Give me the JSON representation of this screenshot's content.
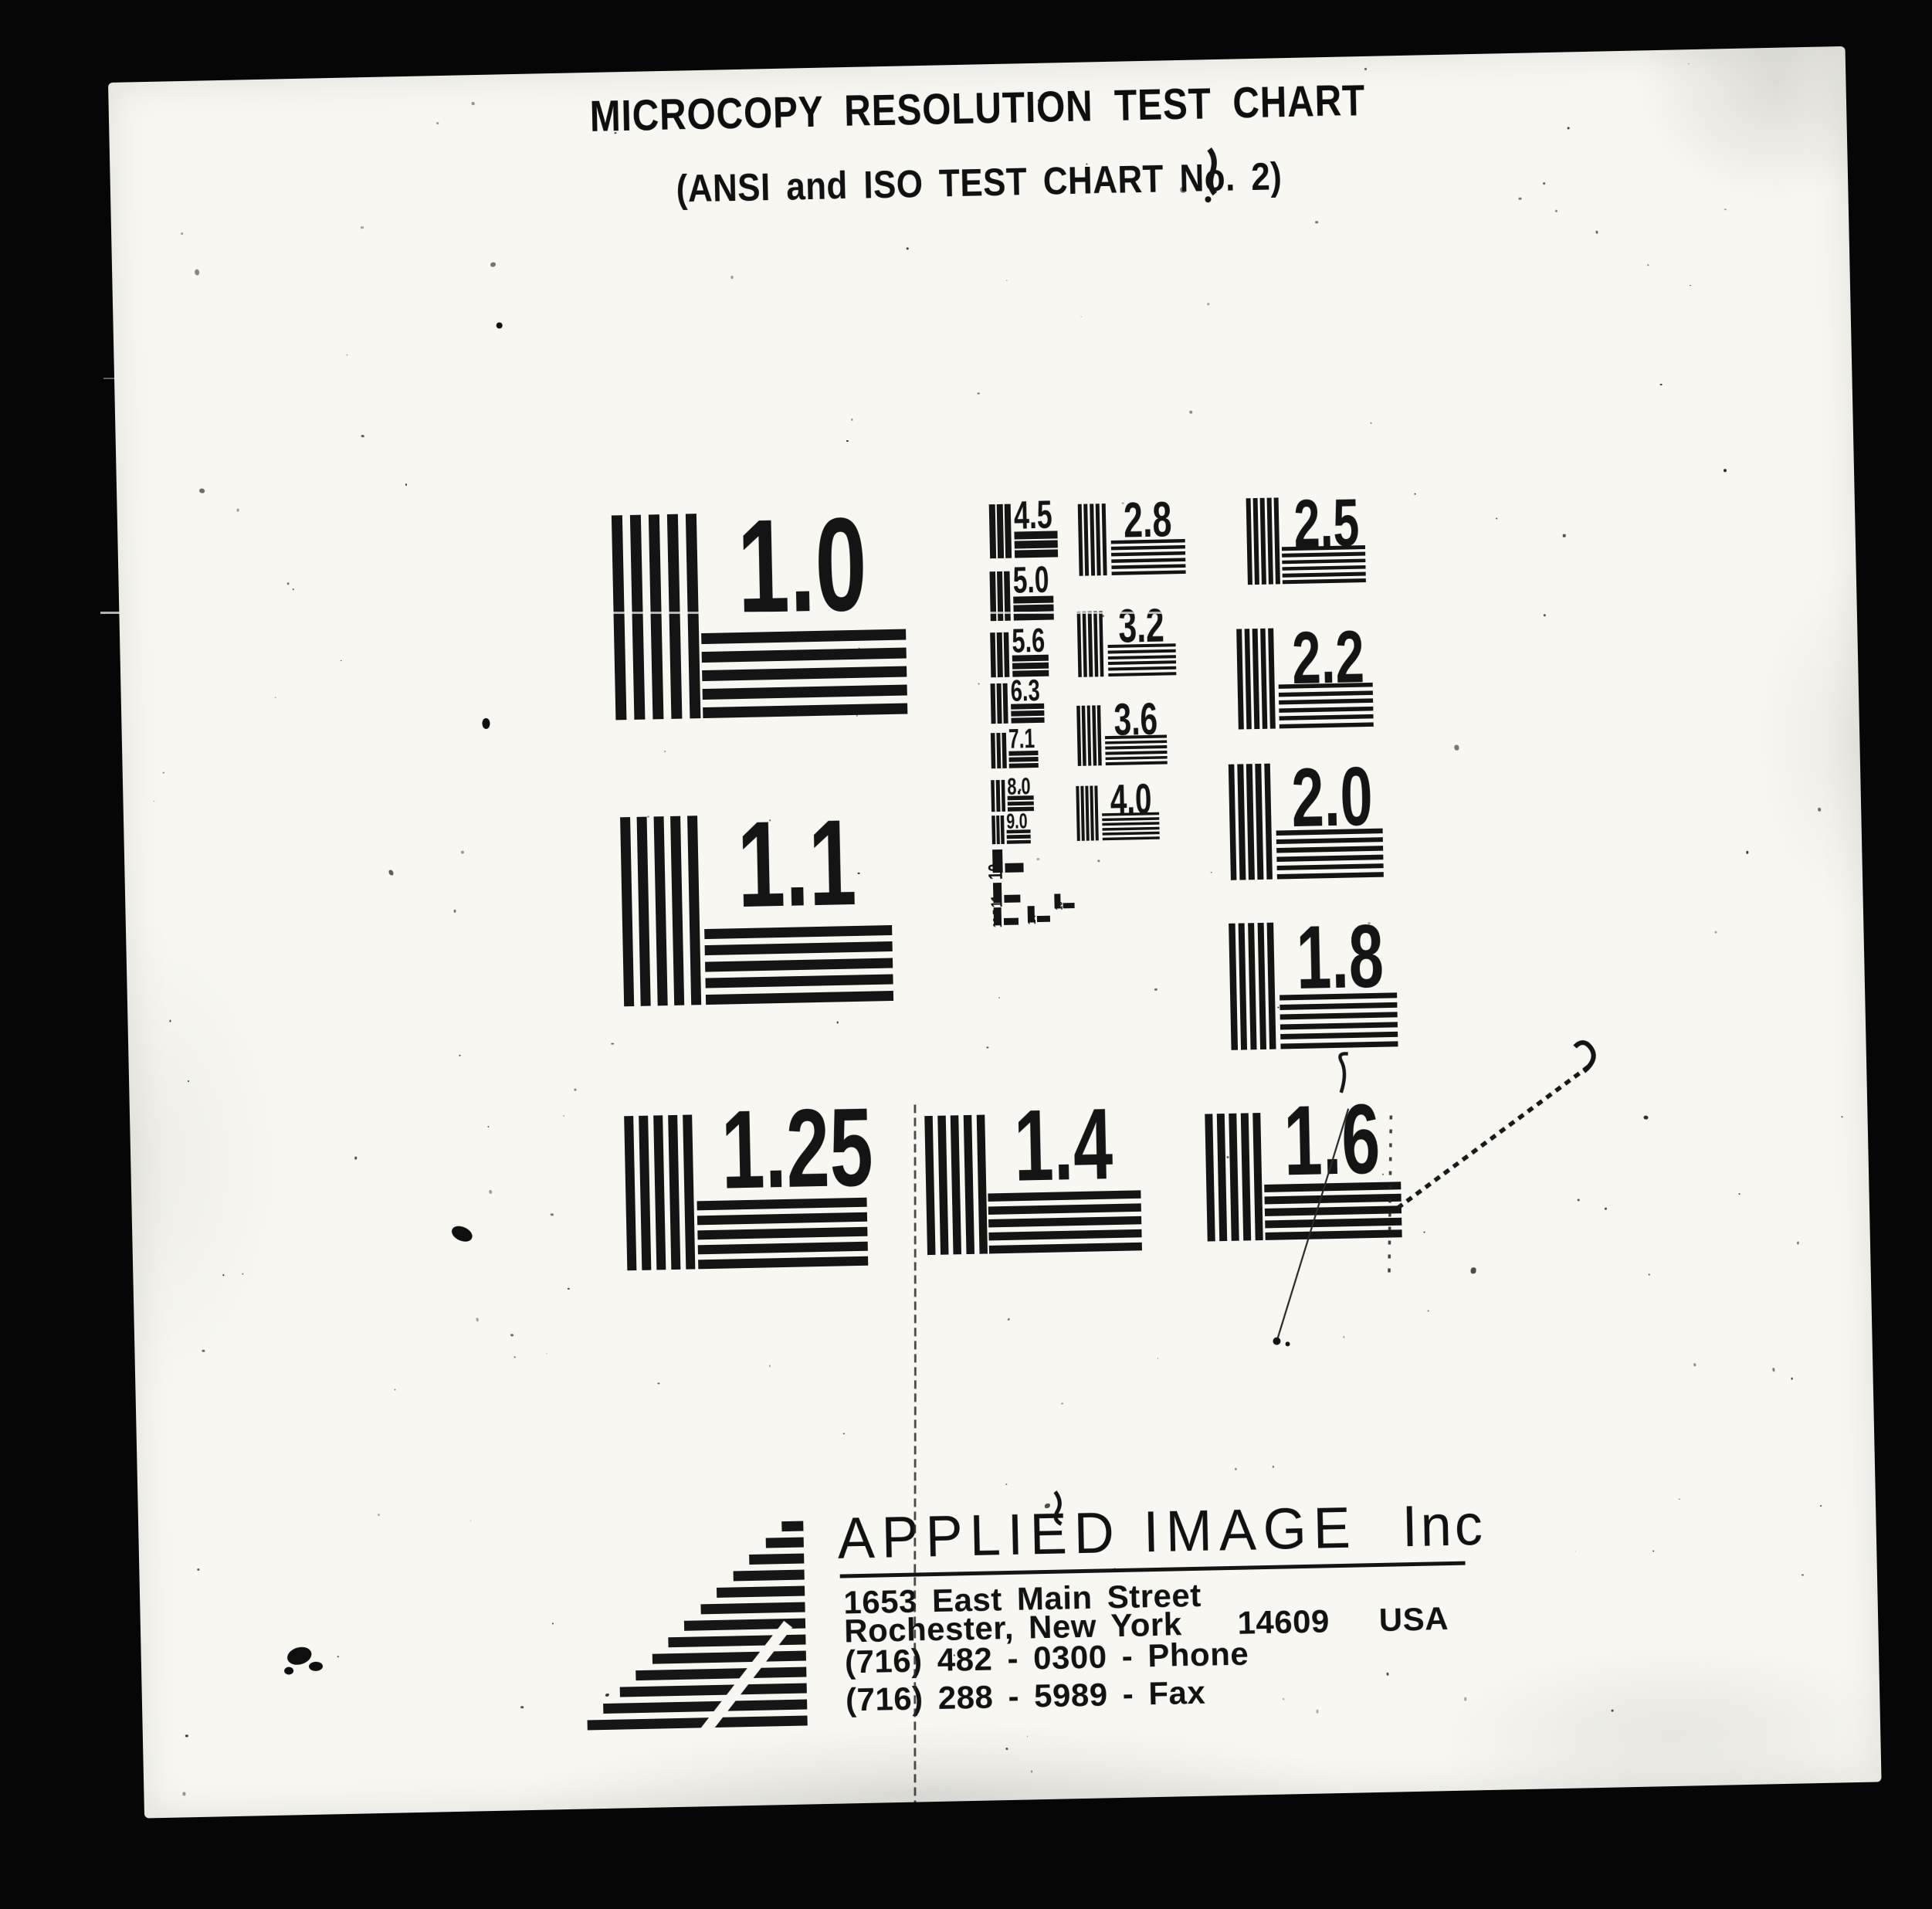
{
  "document": {
    "title": "MICROCOPY RESOLUTION TEST CHART",
    "subtitle": "(ANSI and ISO TEST CHART No. 2)",
    "patterns": [
      {
        "label": "1.0"
      },
      {
        "label": "1.1"
      },
      {
        "label": "1.25"
      },
      {
        "label": "1.4"
      },
      {
        "label": "1.6"
      },
      {
        "label": "4.5"
      },
      {
        "label": "5.0"
      },
      {
        "label": "5.6"
      },
      {
        "label": "6.3"
      },
      {
        "label": "7.1"
      },
      {
        "label": "8.0"
      },
      {
        "label": "9.0"
      },
      {
        "label": "10"
      },
      {
        "label": "11"
      },
      {
        "label": "12.5"
      },
      {
        "label": "14"
      },
      {
        "label": "16"
      },
      {
        "label": "2.8"
      },
      {
        "label": "3.2"
      },
      {
        "label": "3.6"
      },
      {
        "label": "4.0"
      },
      {
        "label": "2.5"
      },
      {
        "label": "2.2"
      },
      {
        "label": "2.0"
      },
      {
        "label": "1.8"
      }
    ],
    "footer": {
      "brand": "APPLIED IMAGE",
      "brand_suffix": "Inc",
      "address_line1": "1653 East Main Street",
      "address_city": "Rochester, New York",
      "address_zip": "14609",
      "address_country": "USA",
      "phone": "(716) 482 - 0300 - Phone",
      "fax": "(716) 288 - 5989 - Fax"
    },
    "colors": {
      "paper": "#f6f5ef",
      "ink": "#161616",
      "background": "#060606"
    }
  }
}
